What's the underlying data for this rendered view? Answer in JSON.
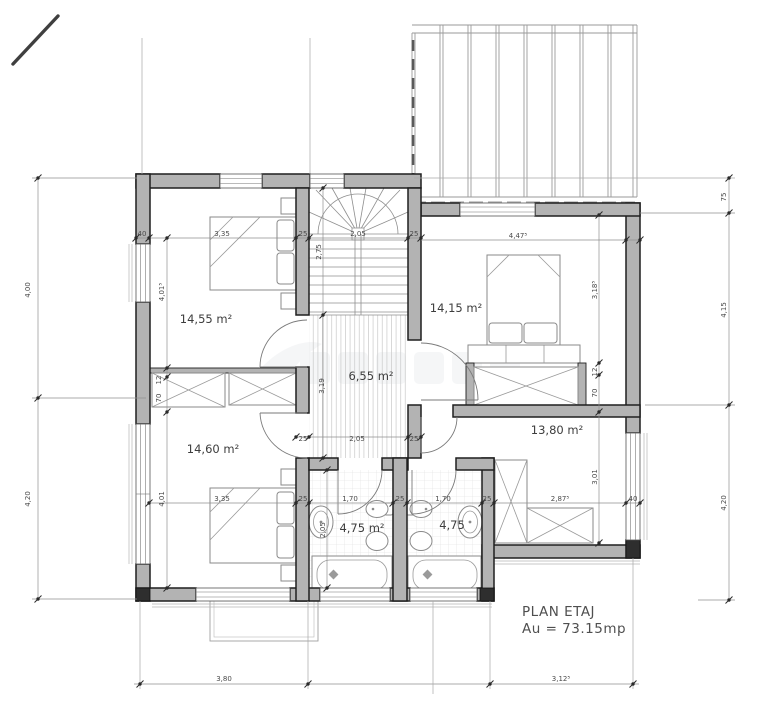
{
  "drawing": {
    "title": "PLAN ETAJ",
    "area": "Au = 73.15mp"
  },
  "rooms": [
    {
      "name": "bedroom-top-left",
      "area": "14,55 m²"
    },
    {
      "name": "bedroom-top-right",
      "area": "14,15 m²"
    },
    {
      "name": "hallway",
      "area": "6,55 m²"
    },
    {
      "name": "bedroom-bottom-left",
      "area": "14,60 m²"
    },
    {
      "name": "bedroom-right",
      "area": "13,80 m²"
    },
    {
      "name": "bathroom-left",
      "area": "4,75 m²"
    },
    {
      "name": "bathroom-right",
      "area": "4,75"
    }
  ],
  "dims": [
    "40",
    "3,35",
    "25",
    "2,05",
    "25",
    "4,47⁵",
    "2,75",
    "4,01⁵",
    "3,18⁵",
    "12",
    "70",
    "12",
    "70",
    "3,19",
    "25",
    "2,05",
    "25",
    "3,35",
    "4,01",
    "25",
    "1,70",
    "25",
    "1,70",
    "25",
    "2,87⁵",
    "40",
    "3,01",
    "2,05",
    "4,00",
    "4,20",
    "75",
    "4,15",
    "4,20",
    "3,80",
    "3,12⁵"
  ],
  "colors": {
    "wall_fill": "#b3b3b3",
    "wall_line": "#1f1f1f",
    "dim_line": "#8f8f8f",
    "dim_text": "#4a4a4a",
    "label_text": "#3d3d3d"
  }
}
